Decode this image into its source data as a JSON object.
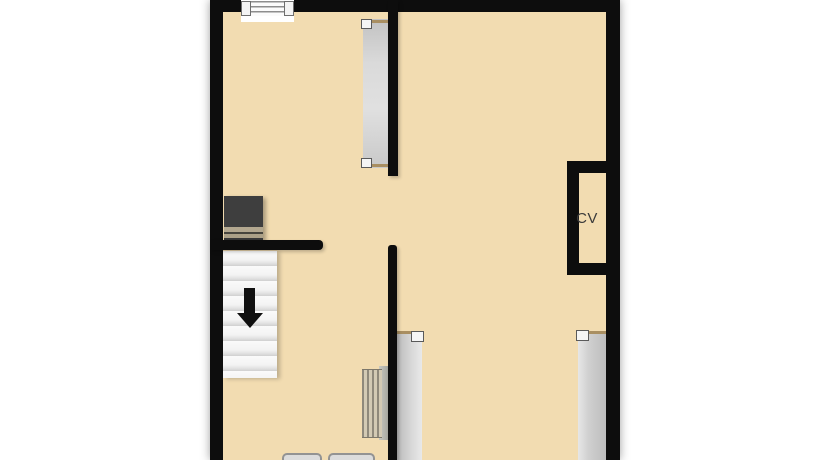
{
  "plan": {
    "type": "floor-plan",
    "labels": {
      "closet": "CV"
    },
    "stairs": {
      "direction": "down",
      "icon": "down-arrow-icon"
    },
    "colors": {
      "background": "#ffffff",
      "floor": "#f2dcb1",
      "wall": "#0d0d0d",
      "door": "#cfcfcf",
      "stairs": "#f2f2f2",
      "furniture": "#3e3e3e",
      "frame": "#a98f62",
      "label_text": "#3a3a3a"
    }
  }
}
